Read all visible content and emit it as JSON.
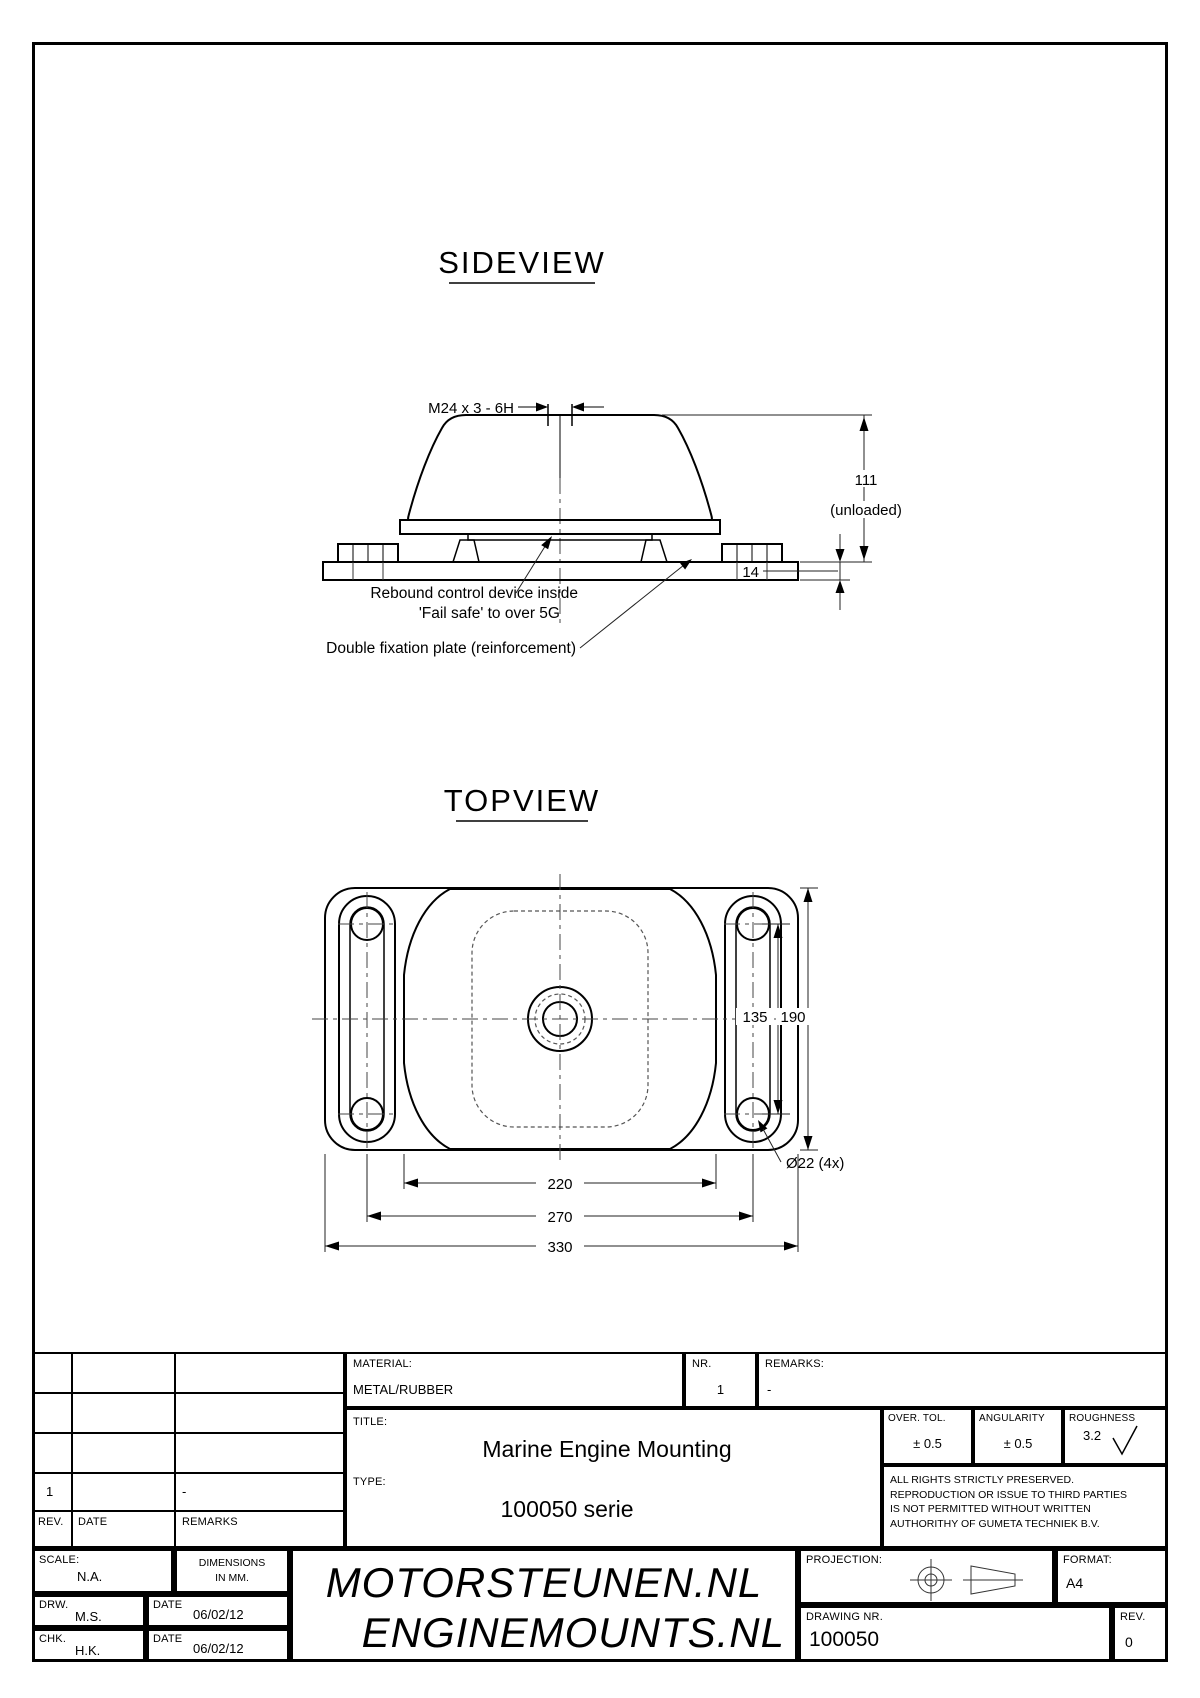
{
  "sideview": {
    "title": "SIDEVIEW",
    "thread_label": "M24 x 3 - 6H",
    "height_dim": "111",
    "height_note": "(unloaded)",
    "base_dim": "14",
    "note1_line1": "Rebound control device inside",
    "note1_line2": "'Fail safe' to over 5G",
    "note2": "Double fixation plate (reinforcement)"
  },
  "topview": {
    "title": "TOPVIEW",
    "dim_135": "135",
    "dim_190": "190",
    "dim_220": "220",
    "dim_270": "270",
    "dim_330": "330",
    "hole_label": "Ø22 (4x)"
  },
  "title_block": {
    "material_label": "MATERIAL:",
    "material_value": "METAL/RUBBER",
    "nr_label": "NR.",
    "nr_value": "1",
    "remarks_label": "REMARKS:",
    "remarks_value": "-",
    "title_label": "TITLE:",
    "title_value": "Marine Engine Mounting",
    "type_label": "TYPE:",
    "type_value": "100050 serie",
    "over_tol_label": "OVER. TOL.",
    "over_tol_value": "± 0.5",
    "angularity_label": "ANGULARITY",
    "angularity_value": "± 0.5",
    "roughness_label": "ROUGHNESS",
    "roughness_value": "3.2",
    "rights_line1": "ALL RIGHTS STRICTLY PRESERVED.",
    "rights_line2": "REPRODUCTION OR ISSUE TO THIRD PARTIES",
    "rights_line3": "IS NOT PERMITTED WITHOUT WRITTEN",
    "rights_line4": "AUTHORITHY OF GUMETA TECHNIEK B.V.",
    "revision_header": {
      "rev": "REV.",
      "date": "DATE",
      "remarks": "REMARKS"
    },
    "revision_row": {
      "rev": "1",
      "remarks": "-"
    },
    "scale_label": "SCALE:",
    "scale_value": "N.A.",
    "dimensions_note_line1": "DIMENSIONS",
    "dimensions_note_line2": "IN MM.",
    "drw_label": "DRW.",
    "drw_value": "M.S.",
    "chk_label": "CHK.",
    "chk_value": "H.K.",
    "date_label": "DATE",
    "drw_date": "06/02/12",
    "chk_date": "06/02/12",
    "brand_line1": "MOTORSTEUNEN.NL",
    "brand_line2": "ENGINEMOUNTS.NL",
    "projection_label": "PROJECTION:",
    "format_label": "FORMAT:",
    "format_value": "A4",
    "drawing_nr_label": "DRAWING NR.",
    "drawing_nr_value": "100050",
    "rev_label": "REV.",
    "rev_value": "0"
  }
}
